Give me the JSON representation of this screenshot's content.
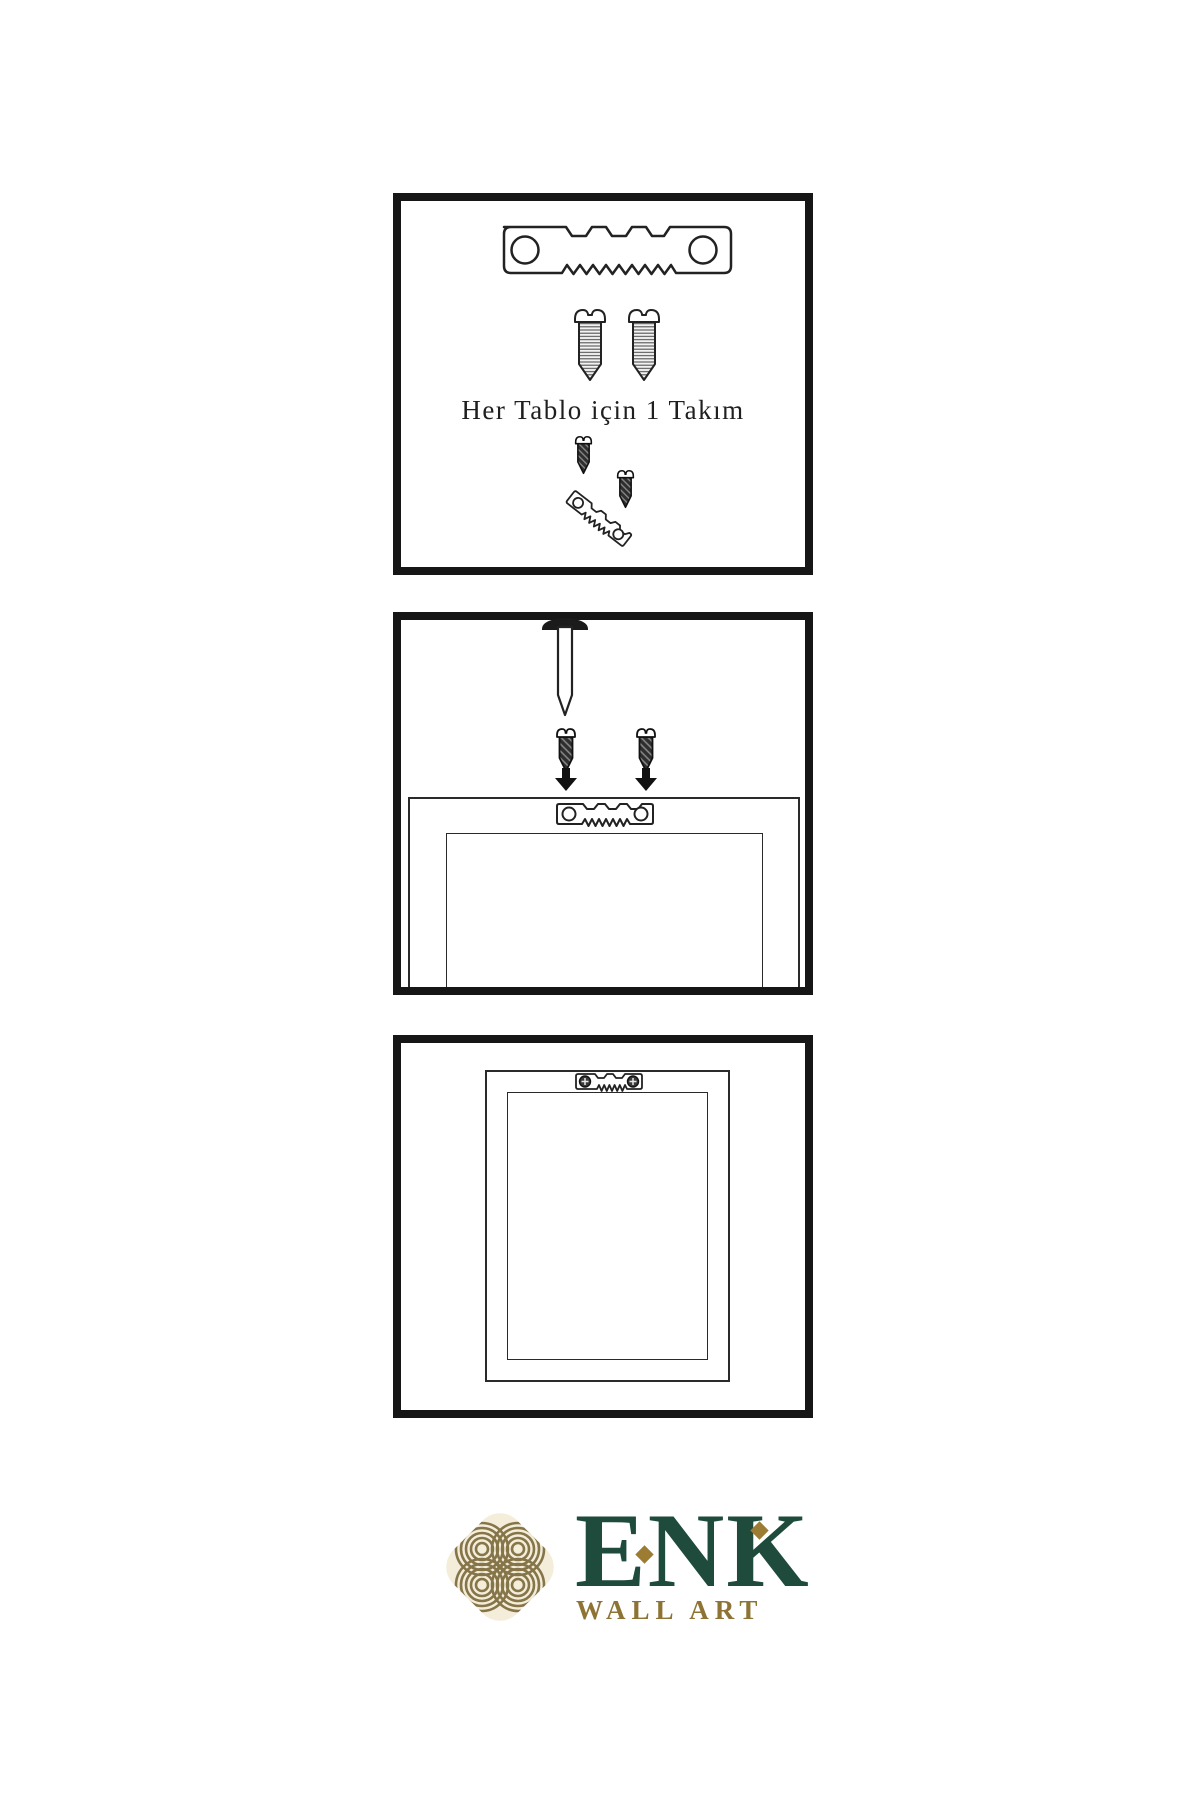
{
  "panel_kit": {
    "caption": "Her Tablo için 1 Takım"
  },
  "logo": {
    "brand": "ENK",
    "subtitle": "WALL ART"
  },
  "colors": {
    "line_art": "#222222",
    "panel_border": "#161616",
    "brand_green": "#1E4B3C",
    "brand_gold": "#9C7B33",
    "logo_olive": "#857549",
    "logo_cream": "#F3EDD9"
  },
  "icons": {
    "sawtooth_hanger": "sawtooth-hanger-icon",
    "screw": "screw-icon",
    "dark_screw": "dark-screw-icon",
    "nail": "nail-icon",
    "down_arrow": "down-arrow-icon",
    "frame": "picture-frame-icon",
    "knot": "knot-logo-icon"
  }
}
